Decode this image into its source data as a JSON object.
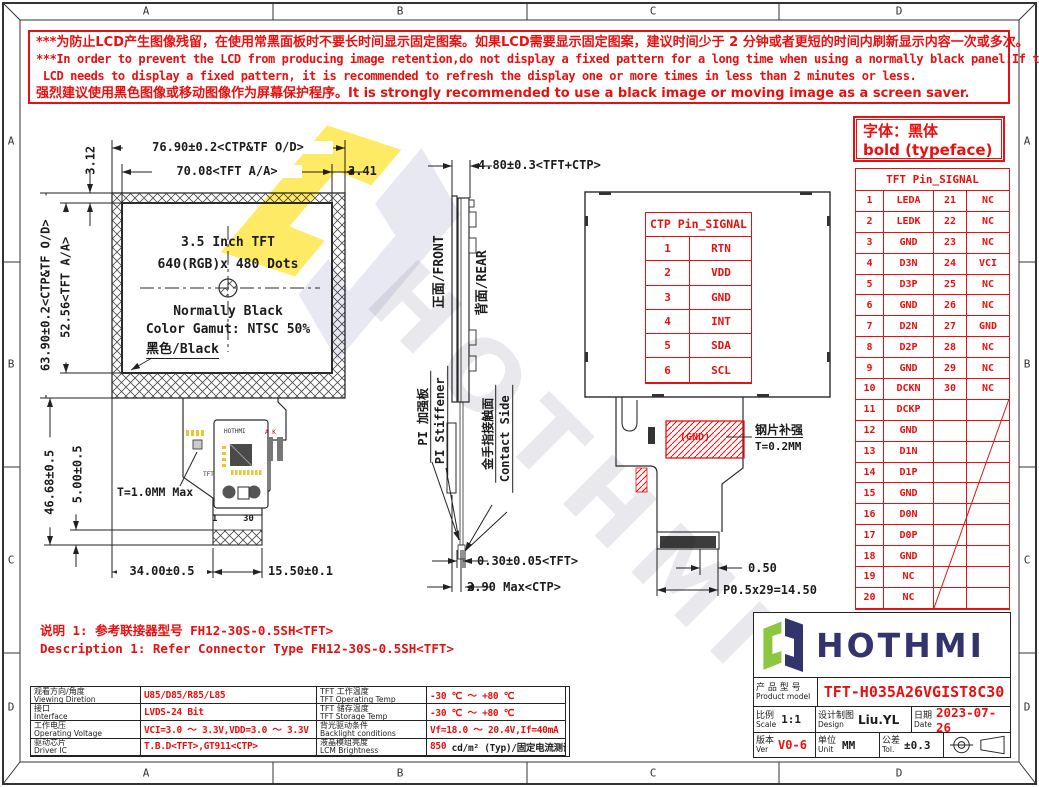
{
  "colors": {
    "red": "#e81010",
    "line": "#2b2b2b",
    "navy": "#33346e",
    "green": "#8dc63f",
    "yellow": "#ffe95e",
    "lavender": "#e6e6f2"
  },
  "frame": {
    "cols": [
      "A",
      "B",
      "C",
      "D"
    ],
    "rows": [
      "A",
      "B",
      "C",
      "D"
    ]
  },
  "warning": {
    "lines": [
      "***为防止LCD产生图像残留，在使用常黑面板时不要长时间显示固定图案。如果LCD需要显示固定图案，建议时间少于 2 分钟或者更短的时间内刷新显示内容一次或多次。",
      "***In order to prevent the LCD from producing image retention,do not display a fixed pattern for a long time when using a normally black panel.If the",
      " LCD needs to display a fixed pattern, it is recommended to refresh the display one or more times in less than 2 minutes or less.",
      "强烈建议使用黑色图像或移动图像作为屏幕保护程序。It is strongly recommended to use a black image or moving image as a screen saver."
    ]
  },
  "font_note": {
    "line1": "字体：黑体",
    "line2": "bold (typeface)"
  },
  "front_view": {
    "size": "3.5 Inch TFT",
    "resolution": "640(RGB)x 480 Dots",
    "mode": "Normally Black",
    "gamut": "Color Gamut: NTSC 50%",
    "black_label": "黑色/Black",
    "thickness": "T=1.0MM Max",
    "pin_first": "1",
    "pin_last": "30"
  },
  "dims": {
    "top_od": "76.90±0.2<CTP&TF O/D>",
    "top_aa": "70.08<TFT A/A>",
    "right_offset": "3.41",
    "top_offset": "3.12",
    "left_od": "63.90±0.2<CTP&TF O/D>",
    "left_aa": "52.56<TFT A/A>",
    "fpc_height": "46.68±0.5",
    "finger_len": "5.00±0.5",
    "bottom_left": "34.00±0.5",
    "bottom_right": "15.50±0.1",
    "side_total": "4.80±0.3<TFT+CTP>",
    "side_tft": "0.30±0.05<TFT>",
    "side_ctp": "2.90 Max<CTP>",
    "rear_pitch": "0.50",
    "rear_pitch_total": "P0.5x29=14.50"
  },
  "side_view": {
    "front": "正面/FRONT",
    "rear": "背面/REAR",
    "pi_zh": "PI 加强板",
    "pi_en": "PI Stiffener",
    "gold_zh": "金手指接触面",
    "gold_en": "Contact Side"
  },
  "rear_view": {
    "gnd": "(GND)",
    "steel_zh": "钢片补强",
    "steel_t": "T=0.2MM"
  },
  "ctp_table": {
    "title": "CTP Pin_SIGNAL",
    "rows": [
      [
        "1",
        "RTN"
      ],
      [
        "2",
        "VDD"
      ],
      [
        "3",
        "GND"
      ],
      [
        "4",
        "INT"
      ],
      [
        "5",
        "SDA"
      ],
      [
        "6",
        "SCL"
      ]
    ]
  },
  "tft_table": {
    "title": "TFT Pin_SIGNAL",
    "rows": [
      [
        "1",
        "LEDA",
        "21",
        "NC"
      ],
      [
        "2",
        "LEDK",
        "22",
        "NC"
      ],
      [
        "3",
        "GND",
        "23",
        "NC"
      ],
      [
        "4",
        "D3N",
        "24",
        "VCI"
      ],
      [
        "5",
        "D3P",
        "25",
        "NC"
      ],
      [
        "6",
        "GND",
        "26",
        "NC"
      ],
      [
        "7",
        "D2N",
        "27",
        "GND"
      ],
      [
        "8",
        "D2P",
        "28",
        "NC"
      ],
      [
        "9",
        "GND",
        "29",
        "NC"
      ],
      [
        "10",
        "DCKN",
        "30",
        "NC"
      ],
      [
        "11",
        "DCKP",
        "",
        ""
      ],
      [
        "12",
        "GND",
        "",
        ""
      ],
      [
        "13",
        "D1N",
        "",
        ""
      ],
      [
        "14",
        "D1P",
        "",
        ""
      ],
      [
        "15",
        "GND",
        "",
        ""
      ],
      [
        "16",
        "D0N",
        "",
        ""
      ],
      [
        "17",
        "D0P",
        "",
        ""
      ],
      [
        "18",
        "GND",
        "",
        ""
      ],
      [
        "19",
        "NC",
        "",
        ""
      ],
      [
        "20",
        "NC",
        "",
        ""
      ]
    ]
  },
  "notes": {
    "line1": "说明 1: 参考联接器型号 FH12-30S-0.5SH<TFT>",
    "line2": "Description 1: Refer Connector Type FH12-30S-0.5SH<TFT>"
  },
  "spec_table": {
    "rows": [
      {
        "zh": "观看方向/角度",
        "en": "Viewing Diretion",
        "value": "U85/D85/R85/L85",
        "zh2": "TFT 工作温度",
        "en2": "TFT Operating Temp",
        "value2": "-30 ℃ ～ +80 ℃"
      },
      {
        "zh": "接口",
        "en": "Interface",
        "value": "LVDS-24 Bit",
        "zh2": "TFT 储存温度",
        "en2": "TFT Storage Temp",
        "value2": "-30 ℃ ～ +80 ℃"
      },
      {
        "zh": "工作电压",
        "en": "Operating Voltage",
        "value": "VCI=3.0 ～ 3.3V,VDD=3.0 ～ 3.3V",
        "zh2": "背光驱动条件",
        "en2": "Backlight conditions",
        "value2": "Vf=18.0 ～ 20.4V,If=40mA"
      },
      {
        "zh": "驱动芯片",
        "en": "Driver IC",
        "value": "T.B.D<TFT>,GT911<CTP>",
        "zh2": "液晶模组亮度",
        "en2": "LCM Brightness",
        "value2": "850",
        "value2_suffix": " cd/m² (Typ)/固定电流测试"
      }
    ]
  },
  "title_block": {
    "brand": "HOTHMI",
    "product_label_zh": "产 品 型 号",
    "product_label_en": "Product model",
    "product_model": "TFT-H035A26VGIST8C30",
    "scale_zh": "比例",
    "scale_en": "Scale",
    "scale": "1:1",
    "design_zh": "设计制图",
    "design_en": "Design",
    "designer": "Liu.YL",
    "date_zh": "日期",
    "date_en": "Date",
    "date": "2023-07-26",
    "ver_zh": "版本",
    "ver_en": "Ver",
    "ver": "V0-6",
    "unit_zh": "单位",
    "unit_en": "Unit",
    "unit": "MM",
    "tol_zh": "公差",
    "tol_en": "Tol.",
    "tol": "±0.3"
  },
  "watermark": {
    "brand": "HOTHMI"
  },
  "pcb": {
    "brand": "HOTHMI",
    "ak": "A K",
    "tft": "TFT"
  }
}
